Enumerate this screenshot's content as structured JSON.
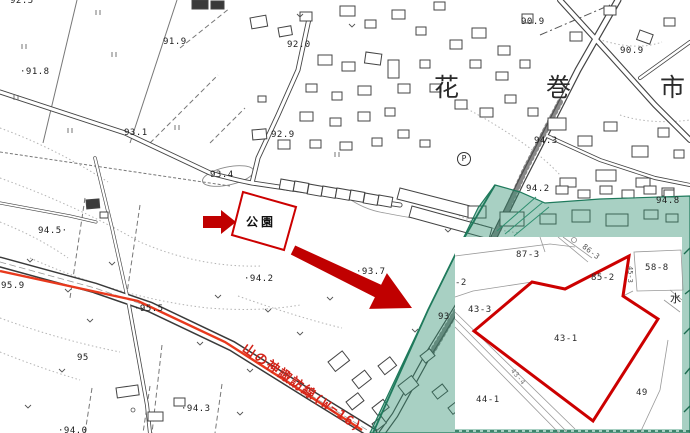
{
  "map": {
    "city_name": "花巻市",
    "city_chars": [
      "花",
      "巻",
      "市"
    ],
    "park_label": "公園",
    "road_label": "山の神諏訪線(W=16)",
    "parking_label": "P",
    "spot_elevations": [
      "92.5",
      "91.9",
      "·91.8",
      "93.1",
      "92.0",
      "92.9",
      "90.9",
      "90.9",
      "93.4",
      "94.3",
      "94.2",
      "94.8",
      "94.5·",
      "·94.2",
      "·93.7",
      "95.9",
      "·95.5",
      "95",
      "·94.3",
      "·94.0",
      "93"
    ],
    "colors": {
      "highlight_green": "#8fc7ad",
      "green_edge": "#1f7a5c",
      "annotation_red": "#cc0000",
      "road_line_red": "#e8391d"
    }
  },
  "inset": {
    "parcel_labels": [
      "87-3",
      "86-3",
      "85-2",
      "58-8",
      "45-3",
      "43-3",
      "43-1",
      "44-1",
      "49",
      "-2",
      "43-4"
    ],
    "highlighted_parcel": "43-1",
    "water_label": "水"
  }
}
